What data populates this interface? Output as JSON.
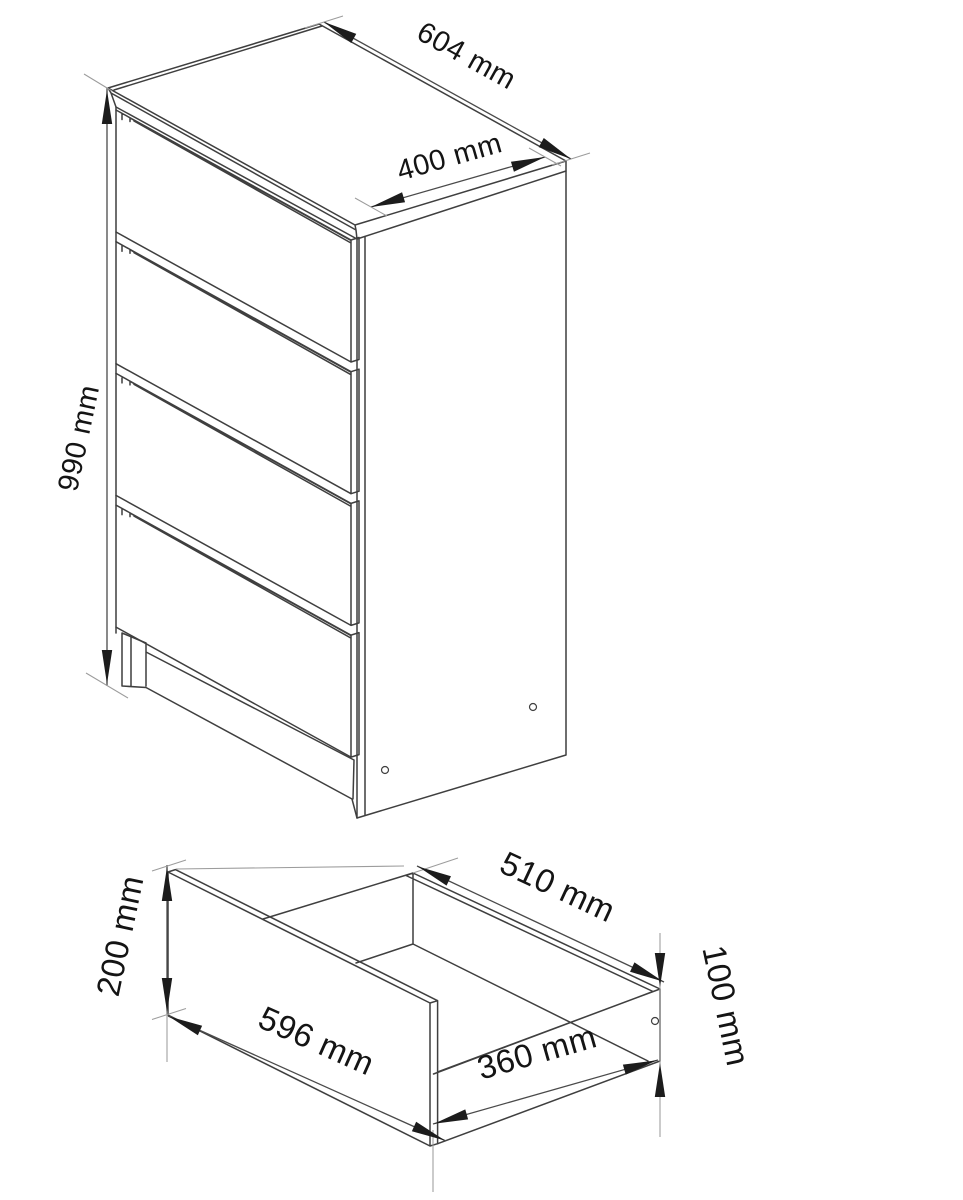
{
  "page": {
    "background": "#ffffff",
    "description": "Technical line drawing of a 4-drawer chest (top view) and a single pulled-out drawer box (bottom view) with millimetre dimensions"
  },
  "colors": {
    "edge": "#3f3f3f",
    "dimension_line": "#4a4a4a",
    "extension_line": "#9c9c9c",
    "arrow": "#1c1c1c",
    "text": "#141414"
  },
  "cabinet_view": {
    "name": "chest-of-drawers",
    "drawer_count": 4,
    "dims": {
      "width": {
        "label": "604 mm"
      },
      "depth": {
        "label": "400 mm"
      },
      "height": {
        "label": "990 mm"
      }
    }
  },
  "drawer_view": {
    "name": "single-drawer-box",
    "dims": {
      "front_width": {
        "label": "596 mm"
      },
      "depth": {
        "label": "510 mm"
      },
      "bottom_depth": {
        "label": "360 mm"
      },
      "front_height": {
        "label": "200 mm"
      },
      "side_height": {
        "label": "100 mm"
      }
    }
  }
}
